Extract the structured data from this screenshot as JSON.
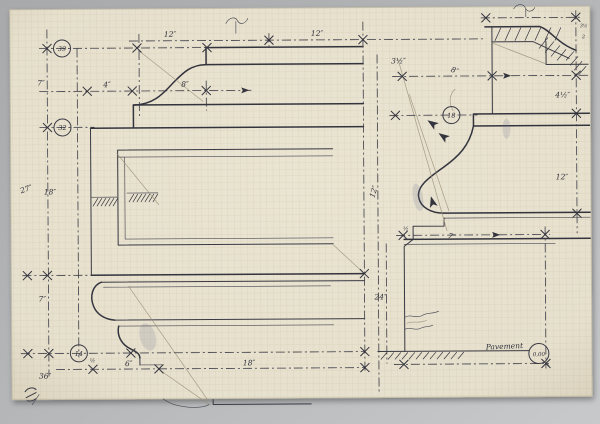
{
  "colors": {
    "background": "#b4b6b8",
    "paper": "#eae4d2",
    "grid": "#b3a988",
    "ink": "#34343e",
    "pencil": "#9b9279"
  },
  "labels": {
    "d12a": "12″",
    "d12b": "12″",
    "d4": "4″",
    "d8a": "8″",
    "d7a": "7″",
    "d27": "27″",
    "d18a": "18″",
    "d7b": "7″",
    "d36": "36″",
    "dhalf_a": "½",
    "d6": "6″",
    "d18b": "18″",
    "d3h": "3½″",
    "d8b": "8″",
    "d4h": "4½″",
    "d12c": "12″",
    "d12r": "12″",
    "d7c": "7″",
    "dhalf_b": "½",
    "d24": "24″",
    "t3h": "3½",
    "t2": "2"
  },
  "levels": {
    "v39": "39",
    "v32": "32",
    "v14": "14",
    "v18": "18",
    "datum": "0,00"
  },
  "annotations": {
    "pavement": "Pavement"
  }
}
